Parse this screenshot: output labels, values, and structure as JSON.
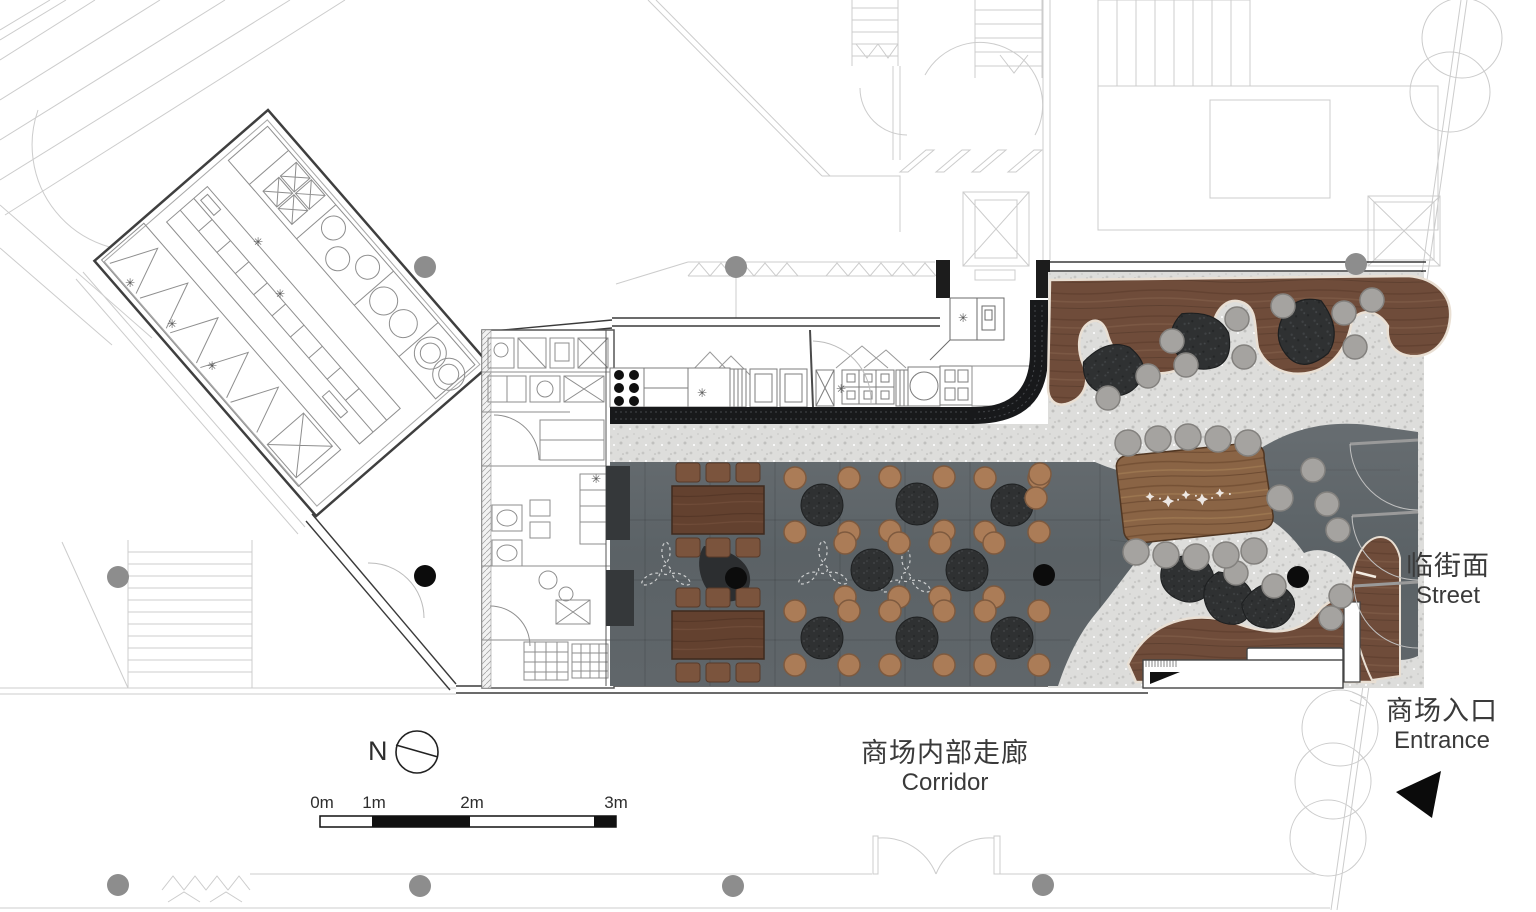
{
  "plan_title": "restaurant-floor-plan",
  "labels": {
    "street_zh": "临街面",
    "street_en": "Street",
    "entrance_zh": "商场入口",
    "entrance_en": "Entrance",
    "corridor_zh": "商场内部走廊",
    "corridor_en": "Corridor",
    "north": "N"
  },
  "scale_bar": {
    "ticks": [
      "0m",
      "1m",
      "2m",
      "3m"
    ]
  },
  "colors": {
    "cad_line": "#cccccc",
    "wall_dark": "#3a3a3a",
    "counter_black": "#18191b",
    "terrazzo": "#dddddb",
    "dining_floor": "#5f666b",
    "wood": "#6f4c3a",
    "wood_light": "#8a6445",
    "cream_edge": "#e9dfd3",
    "pouf_dark": "#2f3132",
    "chair_tan": "#ab7c57",
    "stool_gray": "#a5a3a0",
    "column_gray": "#8d8d8d",
    "column_black": "#0c0c0c"
  },
  "furniture": {
    "round_tables": [
      [
        822,
        505
      ],
      [
        917,
        504
      ],
      [
        1012,
        505
      ],
      [
        872,
        570
      ],
      [
        967,
        570
      ],
      [
        822,
        638
      ],
      [
        917,
        638
      ],
      [
        1012,
        638
      ]
    ],
    "long_tables": [
      [
        718,
        510
      ],
      [
        718,
        635
      ]
    ],
    "communal_table": {
      "x": 1192,
      "y": 497,
      "rot": -3
    },
    "communal_stools": [
      [
        1128,
        443
      ],
      [
        1158,
        439
      ],
      [
        1188,
        437
      ],
      [
        1218,
        439
      ],
      [
        1248,
        443
      ],
      [
        1136,
        552
      ],
      [
        1166,
        555
      ],
      [
        1196,
        557
      ],
      [
        1226,
        555
      ],
      [
        1254,
        551
      ],
      [
        1280,
        498
      ]
    ],
    "fans": [
      [
        666,
        570
      ],
      [
        823,
        569
      ],
      [
        906,
        577
      ]
    ],
    "poufs": [
      [
        1113,
        370,
        -15,
        1.1
      ],
      [
        1200,
        340,
        25,
        1.15
      ],
      [
        1307,
        331,
        85,
        1.2
      ],
      [
        1187,
        578,
        0,
        1.0
      ],
      [
        1228,
        598,
        40,
        1.0
      ],
      [
        1268,
        606,
        -25,
        0.95
      ]
    ],
    "gray_stools": [
      [
        1148,
        376
      ],
      [
        1108,
        398
      ],
      [
        1172,
        341
      ],
      [
        1186,
        365
      ],
      [
        1237,
        319
      ],
      [
        1244,
        357
      ],
      [
        1283,
        306
      ],
      [
        1344,
        313
      ],
      [
        1355,
        347
      ],
      [
        1372,
        300
      ],
      [
        1197,
        557
      ],
      [
        1236,
        573
      ],
      [
        1274,
        586
      ],
      [
        1327,
        504
      ],
      [
        1338,
        530
      ],
      [
        1341,
        596
      ],
      [
        1331,
        618
      ],
      [
        1313,
        470
      ]
    ],
    "tan_stools": [
      [
        1040,
        474
      ],
      [
        1036,
        498
      ]
    ],
    "columns_gray": [
      [
        425,
        267
      ],
      [
        736,
        267
      ],
      [
        1356,
        264
      ],
      [
        118,
        577
      ],
      [
        118,
        885
      ],
      [
        420,
        886
      ],
      [
        733,
        886
      ],
      [
        1043,
        885
      ]
    ],
    "columns_black": [
      [
        425,
        576
      ],
      [
        736,
        578
      ],
      [
        1044,
        575
      ],
      [
        1298,
        577
      ]
    ]
  }
}
